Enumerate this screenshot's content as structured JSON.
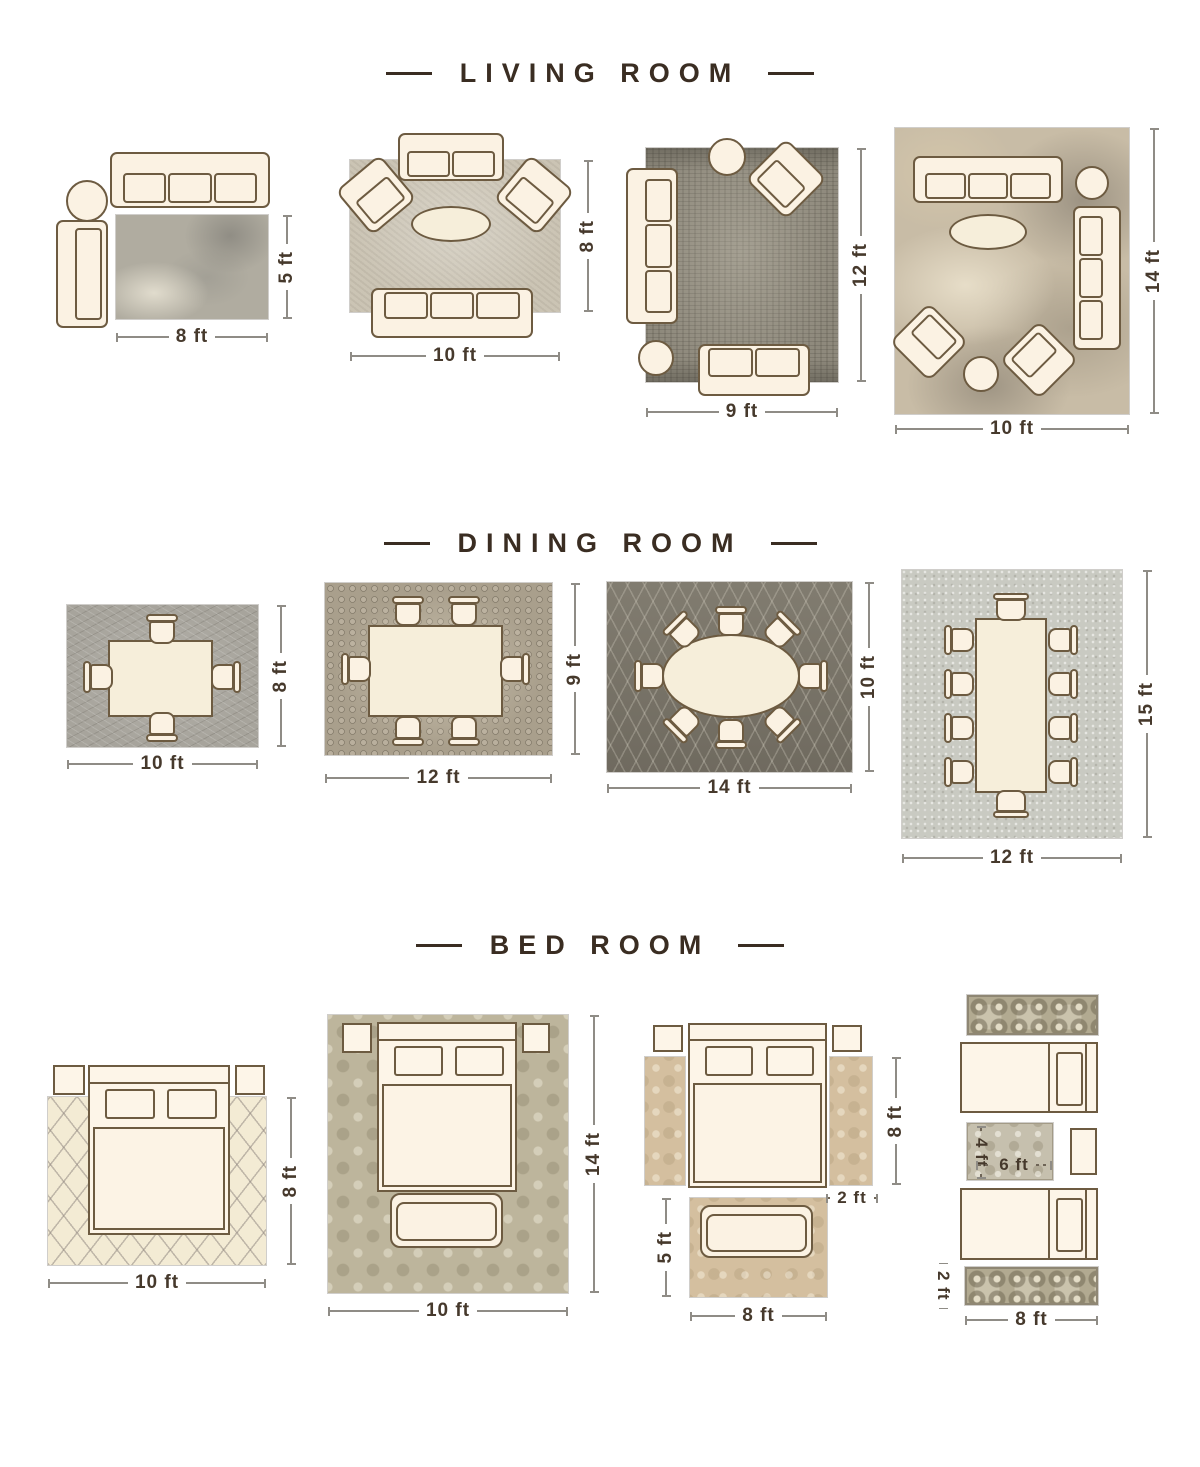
{
  "page": {
    "background": "#ffffff"
  },
  "colors": {
    "title_text": "#3a2d22",
    "dimension_text": "#46392c",
    "furniture_outline": "#6d5b41",
    "furniture_fill": "#fbf2e3"
  },
  "sections": [
    {
      "title": "LIVING ROOM",
      "layouts": [
        {
          "name": "living-8x5",
          "width_label": "8 ft",
          "height_label": "5 ft"
        },
        {
          "name": "living-10x8",
          "width_label": "10 ft",
          "height_label": "8 ft"
        },
        {
          "name": "living-9x12",
          "width_label": "9 ft",
          "height_label": "12 ft"
        },
        {
          "name": "living-10x14",
          "width_label": "10 ft",
          "height_label": "14 ft"
        }
      ]
    },
    {
      "title": "DINING ROOM",
      "layouts": [
        {
          "name": "dining-10x8",
          "width_label": "10 ft",
          "height_label": "8 ft"
        },
        {
          "name": "dining-12x9",
          "width_label": "12 ft",
          "height_label": "9 ft"
        },
        {
          "name": "dining-14x10",
          "width_label": "14 ft",
          "height_label": "10 ft"
        },
        {
          "name": "dining-12x15",
          "width_label": "12 ft",
          "height_label": "15 ft"
        }
      ]
    },
    {
      "title": "BED ROOM",
      "layouts": [
        {
          "name": "bed-10x8",
          "width_label": "10 ft",
          "height_label": "8 ft"
        },
        {
          "name": "bed-10x14",
          "width_label": "10 ft",
          "height_label": "14 ft"
        },
        {
          "name": "bed-runners",
          "side_height_label": "8 ft",
          "runner_width_label": "2 ft",
          "accent_height_label": "5 ft",
          "accent_width_label": "8 ft"
        },
        {
          "name": "bed-twin",
          "small_rug_height_label": "4 ft",
          "small_rug_width_label": "6 ft",
          "runner_height_label": "2 ft",
          "width_label": "8 ft"
        }
      ]
    }
  ]
}
